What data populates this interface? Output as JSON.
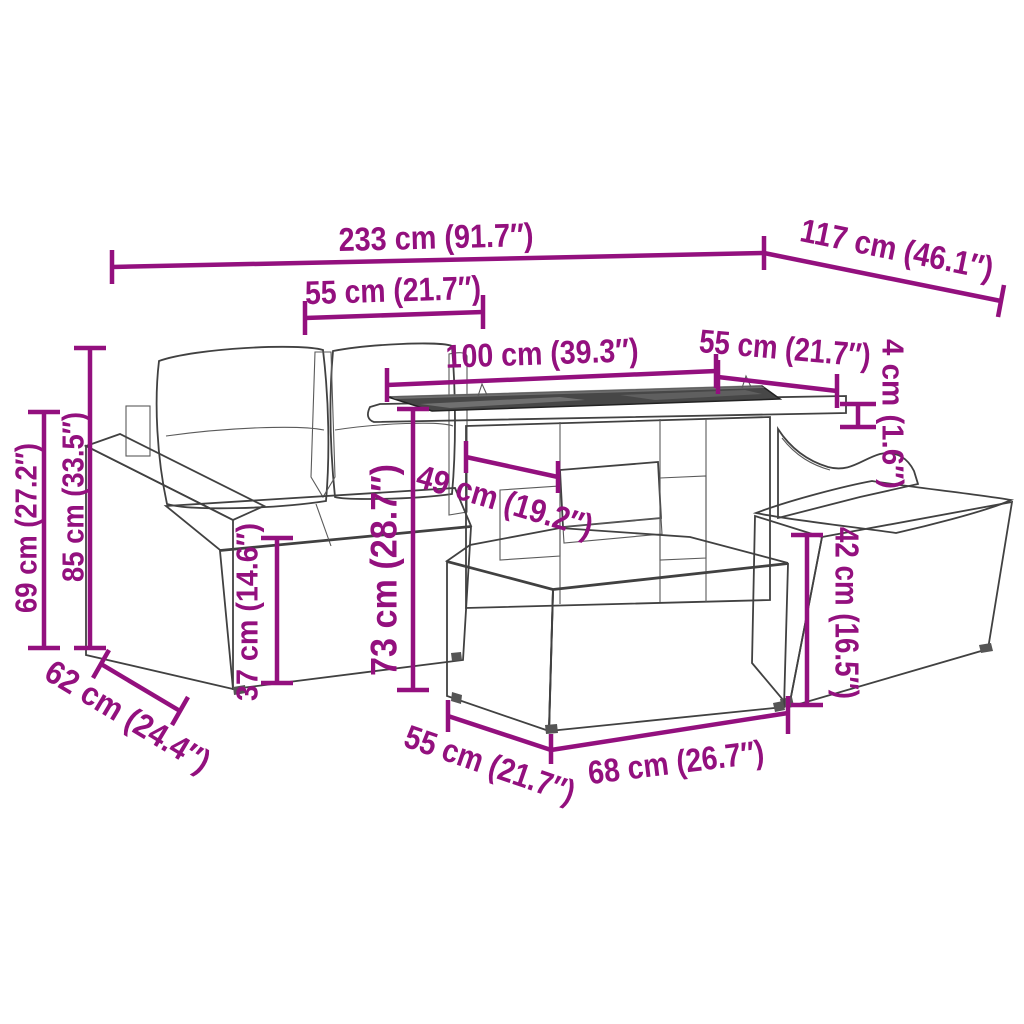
{
  "diagram": {
    "accent_color": "#93107e",
    "drawing_color": "#414141",
    "dimensions": {
      "d233": "233 cm (91.7″)",
      "d117": "117 cm (46.1″)",
      "d55_top": "55 cm (21.7″)",
      "d100": "100 cm (39.3″)",
      "d55_right": "55 cm (21.7″)",
      "d4": "4 cm (1.6″)",
      "d85": "85 cm (33.5″)",
      "d69": "69 cm (27.2″)",
      "d37": "37 cm (14.6″)",
      "d73": "73 cm (28.7″)",
      "d49": "49 cm (19.2″)",
      "d42": "42 cm (16.5″)",
      "d62": "62 cm (24.4″)",
      "d55_bottom": "55 cm (21.7″)",
      "d68": "68 cm (26.7″)"
    }
  }
}
